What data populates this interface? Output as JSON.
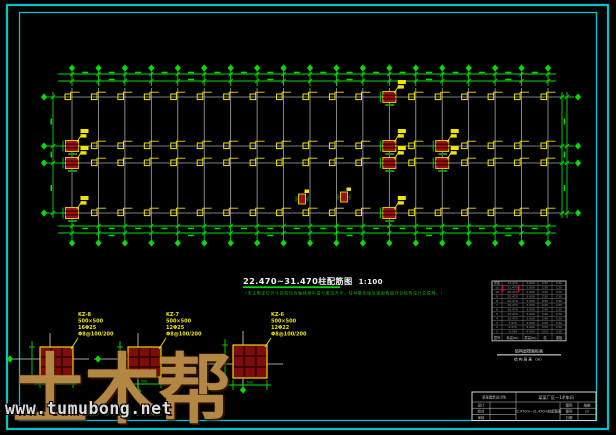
{
  "watermark": {
    "logo_text": "土木帮",
    "url": "www.tumubong.net"
  },
  "plan": {
    "title": "22.470~31.470柱配筋图",
    "scale": "1:100",
    "note": "（未注明定位尺寸的柱均为轴线居中或与梁边齐平，柱纵筋连接及锚固构造详见结构设计总说明。）"
  },
  "details": [
    {
      "name": "KZ-8",
      "size": "500×500",
      "rebar": "16Φ25",
      "stirrup": "Φ8@100/200",
      "dim": "500"
    },
    {
      "name": "KZ-7",
      "size": "500×500",
      "rebar": "12Φ25",
      "stirrup": "Φ8@100/200",
      "dim": "500"
    },
    {
      "name": "KZ-6",
      "size": "500×500",
      "rebar": "12Φ22",
      "stirrup": "Φ8@100/200",
      "dim": "500"
    }
  ],
  "storey_table": {
    "header": [
      "层号",
      "标高(m)",
      "层高(m)",
      "柱",
      "梁板"
    ],
    "rows": [
      [
        "屋面",
        "34.470",
        "3.000",
        "C30",
        "C30"
      ],
      [
        "11",
        "31.470",
        "3.000",
        "C30",
        "C30"
      ],
      [
        "10",
        "28.470",
        "3.000",
        "C35",
        "C30"
      ],
      [
        "9",
        "25.470",
        "3.000",
        "C35",
        "C30"
      ],
      [
        "8",
        "22.470",
        "3.000",
        "C35",
        "C30"
      ],
      [
        "7",
        "19.470",
        "3.000",
        "C40",
        "C30"
      ],
      [
        "6",
        "16.470",
        "3.000",
        "C40",
        "C30"
      ],
      [
        "5",
        "13.470",
        "3.000",
        "C40",
        "C30"
      ],
      [
        "4",
        "10.470",
        "3.000",
        "C45",
        "C30"
      ],
      [
        "3",
        "7.470",
        "3.000",
        "C45",
        "C30"
      ],
      [
        "2",
        "4.470",
        "3.000",
        "C50",
        "C30"
      ],
      [
        "1",
        "-0.030",
        "4.500",
        "C50",
        "C30"
      ]
    ],
    "caption_top": "结构层楼面标高",
    "caption_bottom": "结 构 层 高 （m）"
  },
  "title_block": {
    "company": "某某建筑设计院",
    "project": "某某厂区—1#车间",
    "left_rows": [
      {
        "label": "设计",
        "value": ""
      },
      {
        "label": "校对",
        "value": ""
      },
      {
        "label": "审核",
        "value": ""
      }
    ],
    "drawing_title": "22.470m~31.470m柱配筋图",
    "right_rows": [
      {
        "label": "图别",
        "value": "结施"
      },
      {
        "label": "图号",
        "value": "12"
      },
      {
        "label": "日期",
        "value": ""
      }
    ]
  },
  "colors": {
    "frame": "#00c4cc",
    "grid": "#a8a8a8",
    "dim_green": "#00dc00",
    "column_yellow": "#f2e400",
    "column_red": "#9b1212",
    "watermark_tan": "#c89e54"
  }
}
